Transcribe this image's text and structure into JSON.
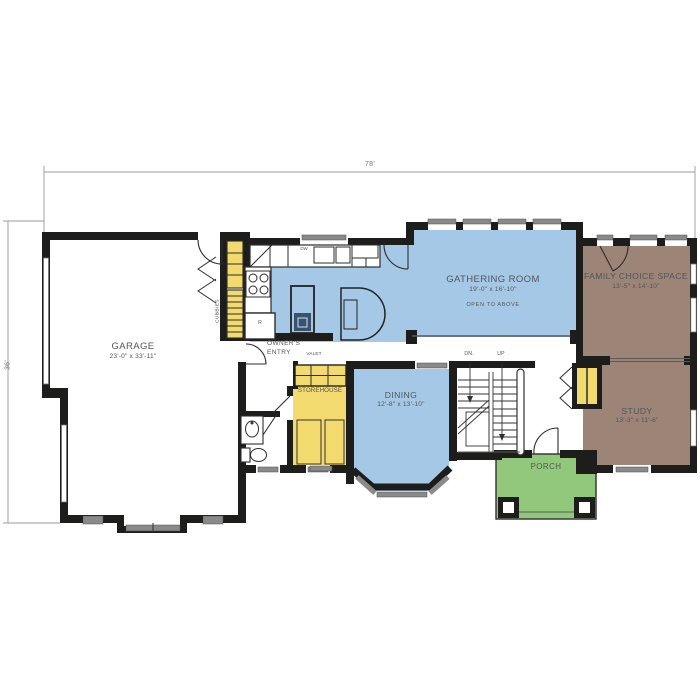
{
  "plan_title": "first-floor-plan",
  "dimensions": {
    "width": "78'",
    "height": "36'"
  },
  "rooms": {
    "garage": {
      "name": "GARAGE",
      "size": "23'-0\" x 33'-11\""
    },
    "gathering": {
      "name": "GATHERING ROOM",
      "size": "19'-0\" x 16'-10\"",
      "note": "OPEN TO ABOVE"
    },
    "family": {
      "name": "FAMILY CHOICE SPACE",
      "size": "13'-5\" x 14'-10\""
    },
    "study": {
      "name": "STUDY",
      "size": "13'-3\" x 11'-6\""
    },
    "dining": {
      "name": "DINING",
      "size": "12'-8\" x 13'-10\""
    },
    "porch": {
      "name": "PORCH"
    },
    "storehouse": {
      "name": "STOREHOUSE"
    },
    "owners_entry": {
      "line1": "OWNER'S",
      "line2": "ENTRY"
    },
    "valet": {
      "name": "VALET"
    },
    "cubbies": {
      "name": "CUBBIES"
    }
  },
  "stairs": {
    "down": "DN.",
    "up": "UP"
  },
  "appliances": {
    "dishwasher": "DW",
    "refrigerator": "R"
  },
  "colors": {
    "floor_blue": "#a4c8e6",
    "floor_brown": "#9c8476",
    "floor_yellow": "#f3da6f",
    "floor_green": "#92c87c",
    "wall": "#1d1d1b",
    "window_gray": "#8a8a8a"
  }
}
